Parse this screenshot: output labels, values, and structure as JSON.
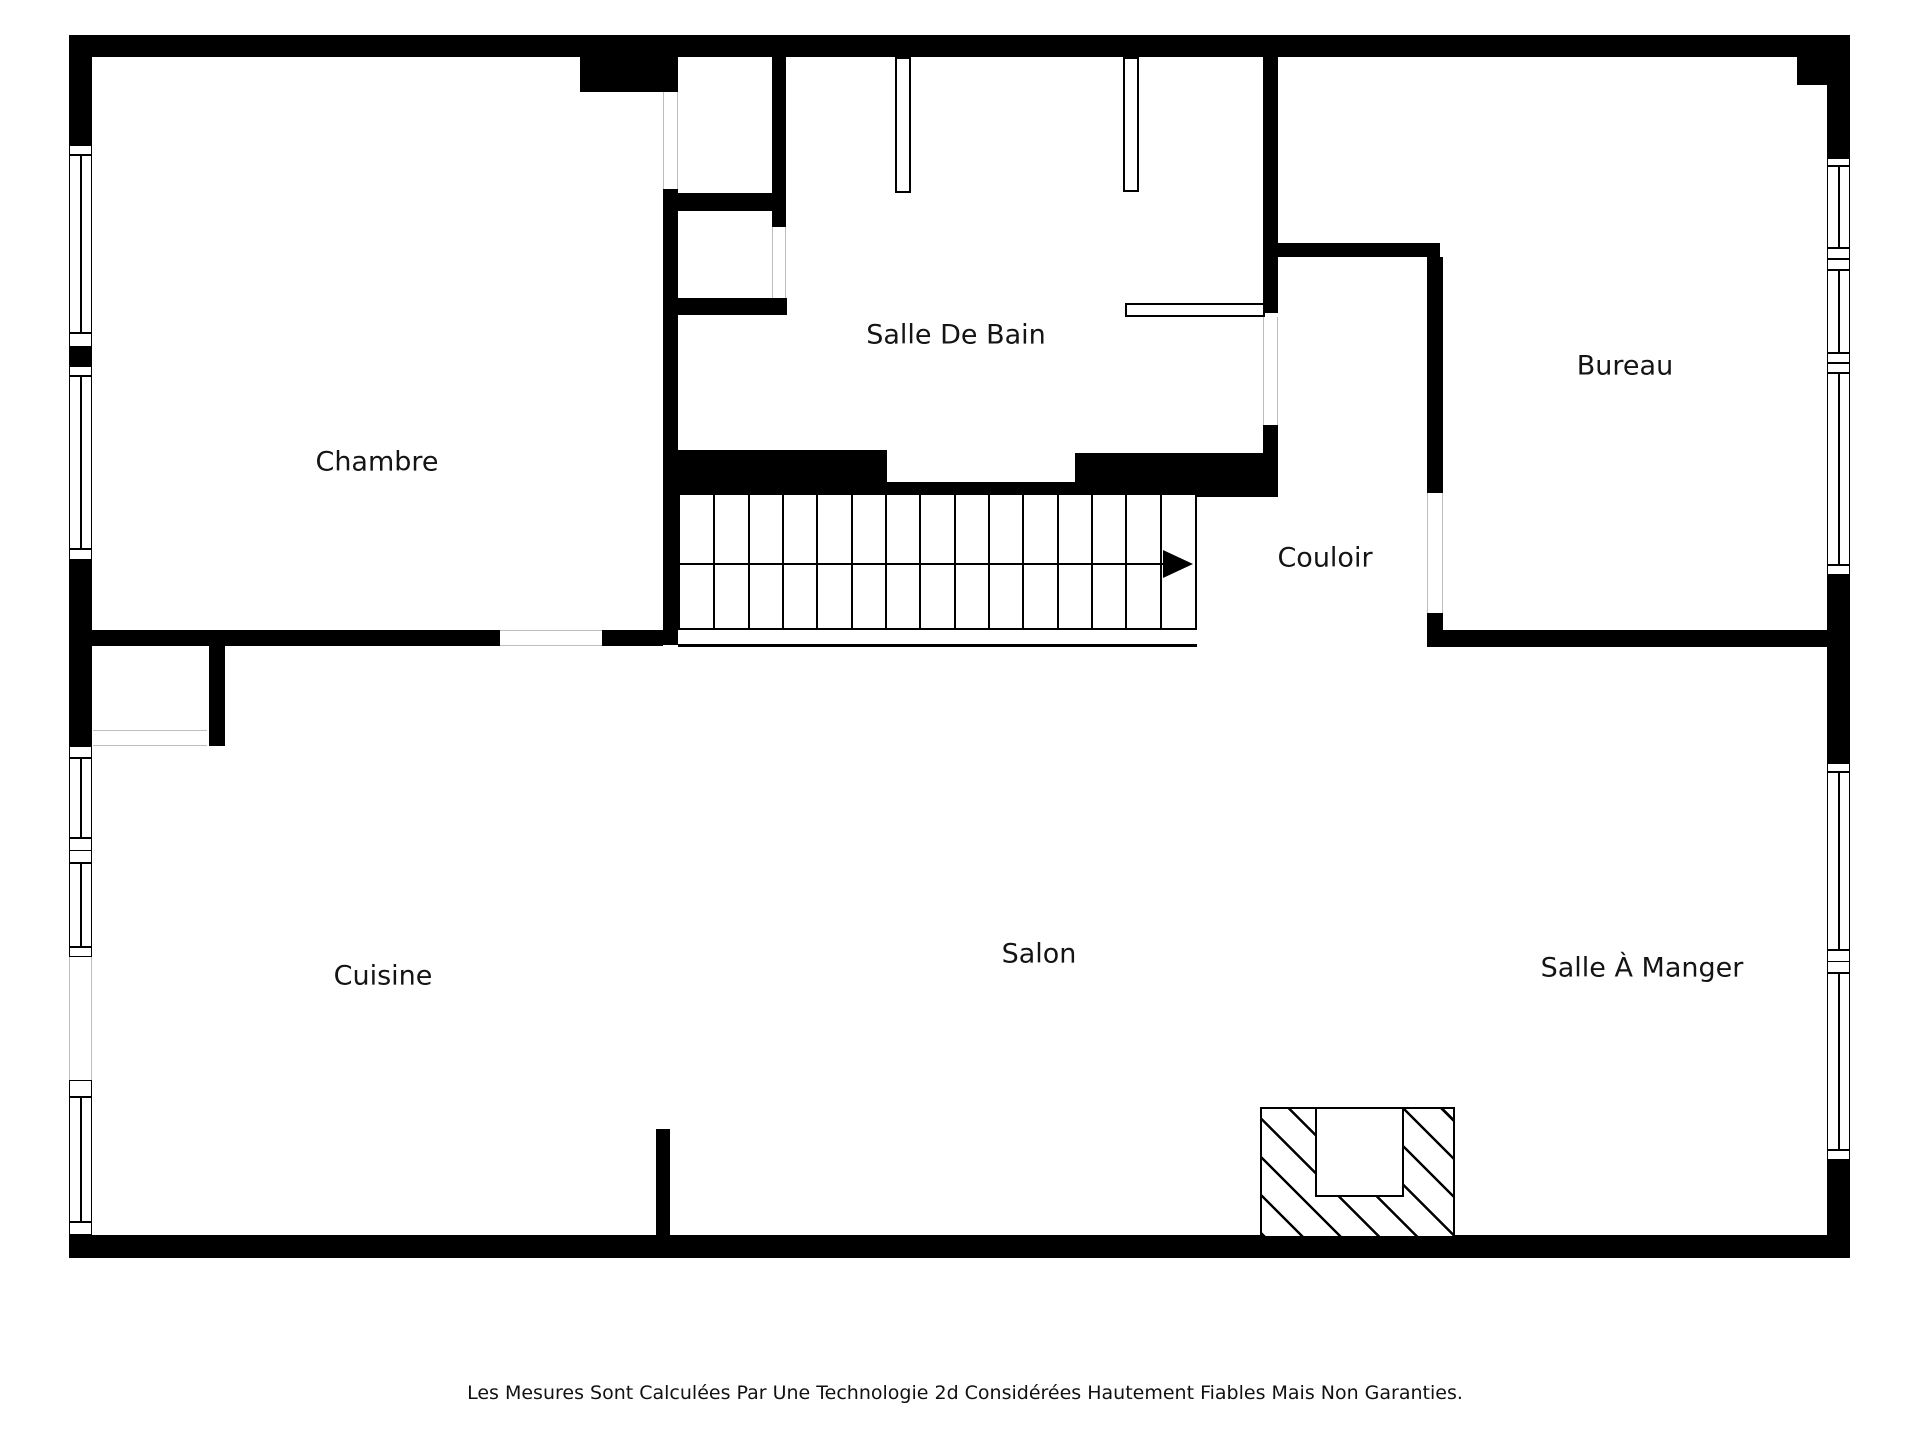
{
  "canvas": {
    "width": 1920,
    "height": 1440,
    "background": "#ffffff",
    "wall_color": "#000000",
    "opening_line_color": "#bdbdbd",
    "label_color": "#141414",
    "label_font_size": 27,
    "disclaimer_font_size": 19
  },
  "rooms": [
    {
      "name": "room-label-chambre",
      "label": "Chambre",
      "x": 377,
      "y": 462
    },
    {
      "name": "room-label-salle-de-bain",
      "label": "Salle De Bain",
      "x": 956,
      "y": 335
    },
    {
      "name": "room-label-bureau",
      "label": "Bureau",
      "x": 1625,
      "y": 366
    },
    {
      "name": "room-label-couloir",
      "label": "Couloir",
      "x": 1325,
      "y": 558
    },
    {
      "name": "room-label-cuisine",
      "label": "Cuisine",
      "x": 383,
      "y": 976
    },
    {
      "name": "room-label-salon",
      "label": "Salon",
      "x": 1039,
      "y": 954
    },
    {
      "name": "room-label-salle-a-manger",
      "label": "Salle À Manger",
      "x": 1642,
      "y": 968
    }
  ],
  "walls": [
    {
      "name": "top-wall",
      "x": 69,
      "y": 35,
      "w": 1781,
      "h": 22
    },
    {
      "name": "top-right-corner-block",
      "x": 1797,
      "y": 35,
      "w": 53,
      "h": 50
    },
    {
      "name": "left-wall-upper",
      "x": 69,
      "y": 57,
      "w": 23,
      "h": 88
    },
    {
      "name": "left-wall-mid",
      "x": 69,
      "y": 347,
      "w": 23,
      "h": 19
    },
    {
      "name": "left-wall-lower",
      "x": 69,
      "y": 560,
      "w": 23,
      "h": 186
    },
    {
      "name": "right-wall-upper",
      "x": 1827,
      "y": 85,
      "w": 23,
      "h": 73
    },
    {
      "name": "right-wall-mid",
      "x": 1827,
      "y": 575,
      "w": 23,
      "h": 188
    },
    {
      "name": "right-wall-lower",
      "x": 1827,
      "y": 1160,
      "w": 23,
      "h": 75
    },
    {
      "name": "bottom-wall",
      "x": 69,
      "y": 1235,
      "w": 1781,
      "h": 23
    },
    {
      "name": "partition-top-block",
      "x": 580,
      "y": 57,
      "w": 98,
      "h": 35
    },
    {
      "name": "chambre-partition-wall",
      "x": 663,
      "y": 189,
      "w": 15,
      "h": 456
    },
    {
      "name": "closet-divider-upper",
      "x": 678,
      "y": 193,
      "w": 94,
      "h": 18
    },
    {
      "name": "closet-divider-lower",
      "x": 678,
      "y": 298,
      "w": 109,
      "h": 17
    },
    {
      "name": "bathroom-west-wall",
      "x": 772,
      "y": 57,
      "w": 14,
      "h": 170
    },
    {
      "name": "chambre-south-wall-left",
      "x": 92,
      "y": 630,
      "w": 408,
      "h": 16
    },
    {
      "name": "chambre-south-wall-right",
      "x": 602,
      "y": 630,
      "w": 61,
      "h": 16
    },
    {
      "name": "bathroom-south-wall-left",
      "x": 663,
      "y": 450,
      "w": 224,
      "h": 43
    },
    {
      "name": "bathroom-door-sill",
      "x": 887,
      "y": 482,
      "w": 188,
      "h": 12
    },
    {
      "name": "bathroom-south-wall-right",
      "x": 1075,
      "y": 453,
      "w": 203,
      "h": 44
    },
    {
      "name": "bathroom-east-wall-upper",
      "x": 1263,
      "y": 57,
      "w": 15,
      "h": 256
    },
    {
      "name": "bathroom-east-wall-lower",
      "x": 1263,
      "y": 425,
      "w": 15,
      "h": 72
    },
    {
      "name": "couloir-north-wall",
      "x": 1278,
      "y": 243,
      "w": 162,
      "h": 14
    },
    {
      "name": "bureau-west-wall",
      "x": 1427,
      "y": 257,
      "w": 16,
      "h": 236
    },
    {
      "name": "bureau-west-wall-block",
      "x": 1427,
      "y": 613,
      "w": 16,
      "h": 17
    },
    {
      "name": "bureau-south-wall",
      "x": 1427,
      "y": 630,
      "w": 423,
      "h": 17
    },
    {
      "name": "kitchen-closet-east-wall",
      "x": 209,
      "y": 646,
      "w": 16,
      "h": 100
    },
    {
      "name": "salon-stub-wall",
      "x": 656,
      "y": 1129,
      "w": 14,
      "h": 106
    }
  ],
  "windows": [
    {
      "name": "chambre-window-1",
      "x": 69,
      "y": 155,
      "w": 23,
      "h": 178
    },
    {
      "name": "chambre-window-2",
      "x": 69,
      "y": 376,
      "w": 23,
      "h": 173
    },
    {
      "name": "cuisine-window-1",
      "x": 69,
      "y": 758,
      "w": 23,
      "h": 80
    },
    {
      "name": "cuisine-window-2",
      "x": 69,
      "y": 863,
      "w": 23,
      "h": 84
    },
    {
      "name": "cuisine-window-3",
      "x": 69,
      "y": 1097,
      "w": 23,
      "h": 125
    },
    {
      "name": "bureau-window-1",
      "x": 1827,
      "y": 166,
      "w": 23,
      "h": 82
    },
    {
      "name": "bureau-window-2",
      "x": 1827,
      "y": 270,
      "w": 23,
      "h": 83
    },
    {
      "name": "bureau-window-3",
      "x": 1827,
      "y": 373,
      "w": 23,
      "h": 192
    },
    {
      "name": "salle-a-manger-window-1",
      "x": 1827,
      "y": 772,
      "w": 23,
      "h": 178
    },
    {
      "name": "salle-a-manger-window-2",
      "x": 1827,
      "y": 973,
      "w": 23,
      "h": 177
    }
  ],
  "sills": [
    {
      "name": "sill",
      "x": 69,
      "y": 145,
      "w": 23,
      "h": 10
    },
    {
      "name": "sill",
      "x": 69,
      "y": 333,
      "w": 23,
      "h": 14
    },
    {
      "name": "sill",
      "x": 69,
      "y": 366,
      "w": 23,
      "h": 10
    },
    {
      "name": "sill",
      "x": 69,
      "y": 549,
      "w": 23,
      "h": 11
    },
    {
      "name": "sill",
      "x": 69,
      "y": 746,
      "w": 23,
      "h": 12
    },
    {
      "name": "sill",
      "x": 69,
      "y": 838,
      "w": 23,
      "h": 13
    },
    {
      "name": "sill",
      "x": 69,
      "y": 850,
      "w": 23,
      "h": 13
    },
    {
      "name": "sill",
      "x": 69,
      "y": 947,
      "w": 23,
      "h": 10
    },
    {
      "name": "sill",
      "x": 69,
      "y": 1080,
      "w": 23,
      "h": 17
    },
    {
      "name": "sill",
      "x": 69,
      "y": 1222,
      "w": 23,
      "h": 13
    },
    {
      "name": "sill",
      "x": 1827,
      "y": 158,
      "w": 23,
      "h": 8
    },
    {
      "name": "sill",
      "x": 1827,
      "y": 248,
      "w": 23,
      "h": 11
    },
    {
      "name": "sill",
      "x": 1827,
      "y": 259,
      "w": 23,
      "h": 11
    },
    {
      "name": "sill",
      "x": 1827,
      "y": 353,
      "w": 23,
      "h": 10
    },
    {
      "name": "sill",
      "x": 1827,
      "y": 363,
      "w": 23,
      "h": 10
    },
    {
      "name": "sill",
      "x": 1827,
      "y": 565,
      "w": 23,
      "h": 10
    },
    {
      "name": "sill",
      "x": 1827,
      "y": 763,
      "w": 23,
      "h": 9
    },
    {
      "name": "sill",
      "x": 1827,
      "y": 950,
      "w": 23,
      "h": 12
    },
    {
      "name": "sill",
      "x": 1827,
      "y": 961,
      "w": 23,
      "h": 12
    },
    {
      "name": "sill",
      "x": 1827,
      "y": 1150,
      "w": 23,
      "h": 10
    }
  ],
  "openings": [
    {
      "name": "chambre-closet-doorway",
      "o": "v",
      "x": 663,
      "y": 92,
      "w": 15,
      "h": 97
    },
    {
      "name": "bathroom-closet-doorway",
      "o": "v",
      "x": 772,
      "y": 227,
      "w": 14,
      "h": 71
    },
    {
      "name": "bathroom-couloir-doorway",
      "o": "v",
      "x": 1263,
      "y": 317,
      "w": 15,
      "h": 108
    },
    {
      "name": "bureau-doorway",
      "o": "v",
      "x": 1427,
      "y": 493,
      "w": 16,
      "h": 120
    },
    {
      "name": "kitchen-patio-doorway",
      "o": "v",
      "x": 69,
      "y": 957,
      "w": 23,
      "h": 123
    },
    {
      "name": "chambre-doorway",
      "o": "h",
      "x": 500,
      "y": 630,
      "w": 102,
      "h": 16
    },
    {
      "name": "kitchen-closet-doorway",
      "o": "h",
      "x": 93,
      "y": 730,
      "w": 114,
      "h": 16
    }
  ],
  "fixtures": [
    {
      "name": "bathroom-fixture-left",
      "x": 895,
      "y": 57,
      "w": 16,
      "h": 136
    },
    {
      "name": "bathroom-fixture-right",
      "x": 1123,
      "y": 57,
      "w": 16,
      "h": 135
    },
    {
      "name": "bathroom-counter",
      "x": 1125,
      "y": 303,
      "w": 140,
      "h": 14
    }
  ],
  "stairs": {
    "name": "stairs",
    "x": 678,
    "y": 493,
    "w": 519,
    "h": 137,
    "tread_count": 15,
    "mid_y": 69,
    "arrow": {
      "shaft_len": 492,
      "tip_inset": 2,
      "head_len": 30,
      "head_half": 14
    },
    "underline": {
      "x": 678,
      "y": 644,
      "w": 519,
      "h": 3
    }
  },
  "fireplace": {
    "name": "fireplace",
    "x": 1260,
    "y": 1107,
    "w": 195,
    "h": 131,
    "insert": {
      "x": 53,
      "y": -2,
      "w": 85,
      "h": 86
    }
  },
  "disclaimer": {
    "text": "Les Mesures Sont Calculées Par Une Technologie 2d Considérées Hautement Fiables Mais Non Garanties.",
    "x": 965,
    "y": 1393
  }
}
